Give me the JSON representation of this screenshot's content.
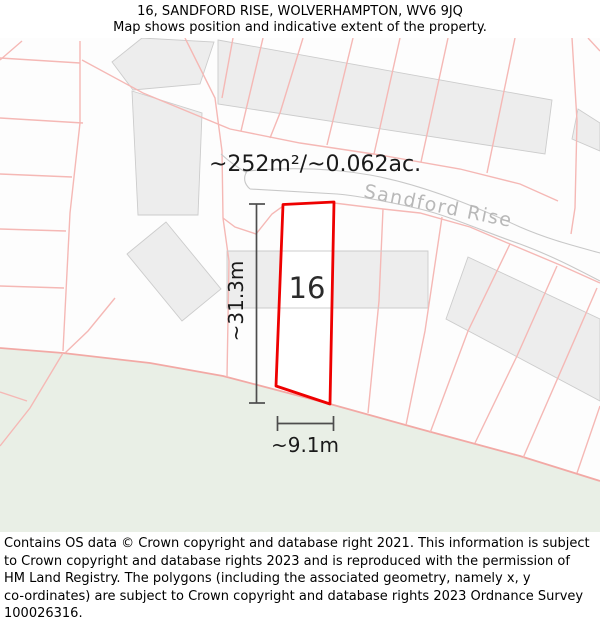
{
  "header": {
    "title": "16, SANDFORD RISE, WOLVERHAMPTON, WV6 9JQ",
    "subtitle": "Map shows position and indicative extent of the property."
  },
  "map": {
    "area_label": "~252m²/~0.062ac.",
    "road_label": "Sandford Rise",
    "plot_number": "16",
    "dim_vertical_label": "~31.3m",
    "dim_horizontal_label": "~9.1m",
    "colors": {
      "plot_outline": "#ee0000",
      "parcel_line": "#f5b8b5",
      "boundary_line": "#f2a9a5",
      "building_fill": "#ededed",
      "building_stroke": "#cccccc",
      "road_casing": "#c8c8c8",
      "road_label_color": "#b8b8b8",
      "green_fill": "#e9efe6",
      "dimension_color": "#4d4d4d",
      "map_text": "#1a1a1a",
      "plot_text": "#2b2b2b"
    }
  },
  "footer": {
    "lines": [
      "Contains OS data © Crown copyright and database right 2021. This information is subject",
      "to Crown copyright and database rights 2023 and is reproduced with the permission of",
      "HM Land Registry. The polygons (including the associated geometry, namely x, y",
      "co-ordinates) are subject to Crown copyright and database rights 2023 Ordnance Survey",
      "100026316."
    ]
  }
}
